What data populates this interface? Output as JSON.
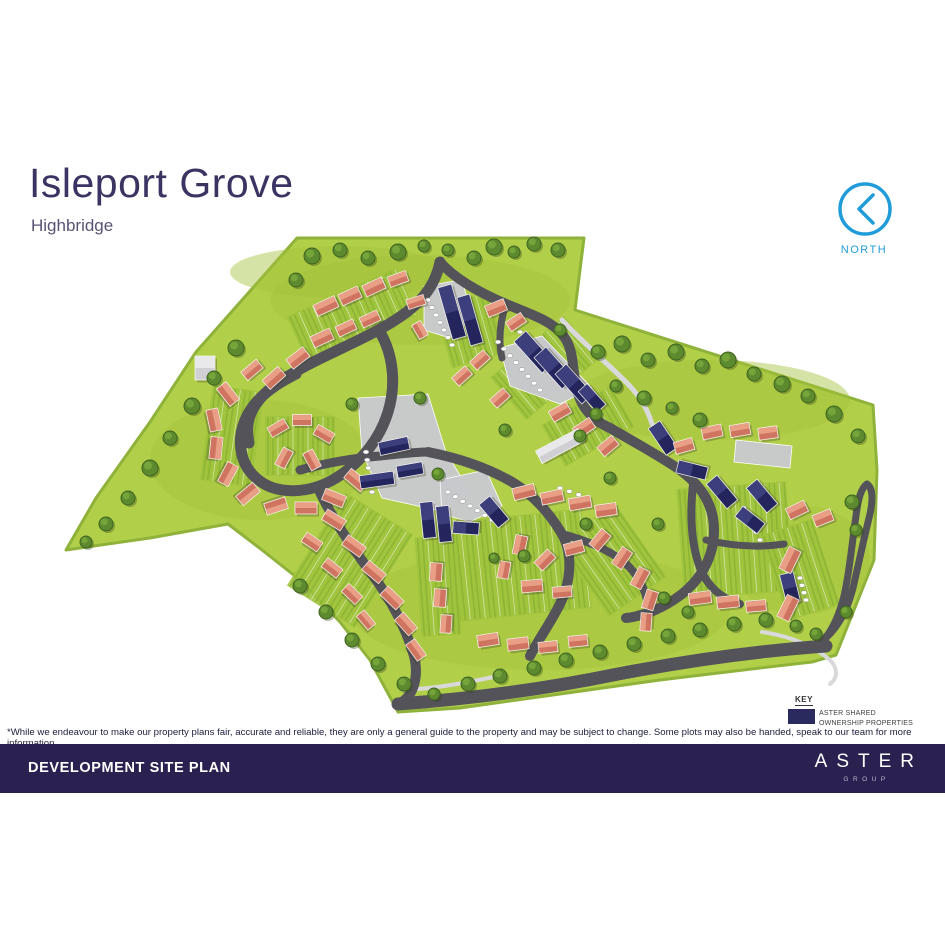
{
  "header": {
    "title": "Isleport Grove",
    "subtitle": "Highbridge"
  },
  "north": {
    "label": "NORTH",
    "color": "#1f9cd9"
  },
  "key": {
    "title": "KEY",
    "swatch_color": "#2b2a5e",
    "line1": "ASTER SHARED",
    "line2": "OWNERSHIP PROPERTIES"
  },
  "disclaimer": "*While we endeavour to make our property plans fair, accurate and reliable, they are only a general guide to the property and may be subject to change. Some plots may also be handed, speak to our team for more information.",
  "footer": {
    "title": "DEVELOPMENT SITE PLAN",
    "brand": "ASTER",
    "brand_sub": "GROUP",
    "bg": "#2a2150"
  },
  "map": {
    "colors": {
      "grass": "#b2cf4a",
      "grass_shade": "#a3c13b",
      "land_edge": "#8fb23a",
      "road": "#54535a",
      "path": "#d9d9dc",
      "parking": "#c9c9ce",
      "garden": "#9fc33d",
      "garden_stripe": "#84ab31",
      "sale_roof": "#cf7460",
      "sale_roof_light": "#e99f86",
      "shared_roof": "#23255c",
      "shared_roof_light": "#3d3f7d",
      "grey_roof": "#cfcfd4",
      "grey_roof_light": "#e9e9ec",
      "tree": "#5d8a2e",
      "tree_dark": "#3f6420",
      "tree_light": "#79a93c"
    },
    "land": [
      "M 297,238 L 584,238 L 575,310 L 873,405 L 877,470 L 874,560 L 836,655 L 812,662 L 760,668 L 660,680 L 560,694 L 460,708 L 398,712 L 370,660 L 340,622 L 300,580 L 262,550 L 228,524 L 150,538 L 66,550 L 96,498 L 150,422 L 196,352 Z"
    ],
    "shade": [
      [
        420,
        300,
        150,
        45
      ],
      [
        710,
        400,
        140,
        40
      ],
      [
        260,
        460,
        110,
        60
      ],
      [
        540,
        610,
        190,
        60
      ],
      [
        800,
        560,
        70,
        55
      ],
      [
        340,
        272,
        110,
        26
      ]
    ],
    "gardens": [
      [
        352,
        316,
        120,
        52,
        -24
      ],
      [
        470,
        330,
        56,
        64,
        -16
      ],
      [
        545,
        368,
        96,
        56,
        -40
      ],
      [
        232,
        436,
        52,
        96,
        8
      ],
      [
        300,
        446,
        70,
        60,
        0
      ],
      [
        350,
        560,
        80,
        110,
        32
      ],
      [
        512,
        566,
        150,
        100,
        -6
      ],
      [
        612,
        560,
        70,
        90,
        -35
      ],
      [
        735,
        540,
        110,
        110,
        -4
      ],
      [
        800,
        570,
        54,
        90,
        -18
      ],
      [
        588,
        426,
        80,
        48,
        -30
      ],
      [
        438,
        586,
        40,
        100,
        -4
      ]
    ],
    "parking": [
      "M 424,286 L 462,280 L 472,316 L 450,338 L 424,330 Z",
      "M 500,348 L 542,336 L 592,388 L 560,404 L 510,386 Z",
      "M 358,398 L 428,394 L 446,452 L 470,492 L 436,510 L 382,498 L 362,452 Z",
      "M 440,480 L 486,470 L 502,506 L 470,522 L 442,514 Z",
      "M 736,440 L 792,446 L 790,468 L 734,462 Z"
    ],
    "lightpaths": [
      [
        "M 562,320 C 584,344 606,362 626,382 C 640,396 648,410 652,424",
        5
      ],
      [
        "M 762,632 C 790,636 814,646 830,660 C 838,668 838,678 830,684",
        4
      ],
      [
        "M 404,690 C 440,688 470,682 498,676",
        4
      ]
    ],
    "roads": [
      [
        "M 440,262 C 434,292 414,310 382,328 C 350,346 312,360 282,380 C 256,397 243,417 249,443",
        11
      ],
      [
        "M 380,332 C 394,356 396,386 388,412 C 380,438 362,462 336,478 C 310,494 276,496 256,478 C 238,462 236,436 248,414 C 258,396 276,384 296,374",
        11
      ],
      [
        "M 300,470 C 330,462 355,458 380,456 C 400,454 415,452 428,452",
        9
      ],
      [
        "M 428,452 C 458,458 488,468 512,482 C 534,495 550,514 562,534 C 574,556 570,584 560,604 C 550,624 538,640 530,656",
        10
      ],
      [
        "M 440,262 C 454,278 478,292 506,304 C 530,314 550,320 562,334 C 574,348 572,366 576,386 C 580,406 592,420 610,428",
        10
      ],
      [
        "M 506,304 C 500,322 498,340 502,358",
        7
      ],
      [
        "M 610,428 C 634,442 660,456 680,470 C 702,486 714,506 714,530 C 714,556 702,578 682,594 C 664,608 644,616 626,618",
        10
      ],
      [
        "M 694,476 C 690,506 690,536 698,562 C 704,582 718,598 740,604",
        8
      ],
      [
        "M 706,540 C 732,546 758,548 784,544",
        7
      ],
      [
        "M 398,704 C 470,699 540,690 618,674 C 696,659 770,650 826,646",
        13
      ],
      [
        "M 812,650 C 828,640 838,620 844,596 C 850,570 852,542 856,516 C 858,499 861,488 867,484",
        7
      ],
      [
        "M 867,484 C 873,488 873,500 870,514 C 864,538 859,562 853,588 C 847,612 836,632 818,644",
        7
      ],
      [
        "M 318,488 C 330,514 348,542 369,570 C 390,598 406,628 414,656 C 419,676 414,694 402,702",
        10
      ],
      [
        "M 562,534 C 584,540 606,548 624,562 C 638,574 646,590 648,606",
        8
      ]
    ],
    "dot_rows": [
      [
        428,
        300,
        452,
        345,
        7
      ],
      [
        498,
        342,
        540,
        390,
        8
      ],
      [
        520,
        332,
        560,
        378,
        8
      ],
      [
        366,
        452,
        372,
        492,
        6
      ],
      [
        448,
        492,
        492,
        520,
        7
      ],
      [
        560,
        488,
        588,
        498,
        4
      ],
      [
        744,
        508,
        760,
        540,
        5
      ],
      [
        800,
        578,
        806,
        600,
        4
      ]
    ],
    "houses": [
      [
        326,
        306,
        23,
        12,
        -25,
        "s"
      ],
      [
        350,
        296,
        21,
        12,
        -25,
        "s"
      ],
      [
        374,
        287,
        21,
        12,
        -25,
        "s"
      ],
      [
        398,
        279,
        19,
        11,
        -20,
        "s"
      ],
      [
        322,
        338,
        21,
        12,
        -25,
        "s"
      ],
      [
        346,
        328,
        19,
        11,
        -25,
        "s"
      ],
      [
        370,
        319,
        19,
        11,
        -25,
        "s"
      ],
      [
        298,
        358,
        21,
        12,
        -38,
        "s"
      ],
      [
        274,
        378,
        21,
        12,
        -42,
        "s"
      ],
      [
        416,
        302,
        18,
        10,
        -18,
        "s"
      ],
      [
        420,
        330,
        16,
        10,
        60,
        "s"
      ],
      [
        452,
        312,
        14,
        54,
        -16,
        "n"
      ],
      [
        470,
        320,
        13,
        50,
        -16,
        "n"
      ],
      [
        496,
        308,
        20,
        12,
        -22,
        "s"
      ],
      [
        516,
        322,
        18,
        11,
        -34,
        "s"
      ],
      [
        534,
        352,
        16,
        42,
        -42,
        "n"
      ],
      [
        554,
        368,
        16,
        42,
        -42,
        "n"
      ],
      [
        574,
        384,
        15,
        40,
        -42,
        "n"
      ],
      [
        592,
        398,
        12,
        28,
        -42,
        "n"
      ],
      [
        480,
        360,
        18,
        11,
        -42,
        "s"
      ],
      [
        462,
        376,
        18,
        11,
        -42,
        "s"
      ],
      [
        500,
        398,
        18,
        11,
        -42,
        "s"
      ],
      [
        205,
        368,
        20,
        24,
        0,
        "g"
      ],
      [
        228,
        394,
        22,
        12,
        52,
        "s"
      ],
      [
        214,
        420,
        22,
        12,
        78,
        "s"
      ],
      [
        216,
        448,
        22,
        12,
        96,
        "s"
      ],
      [
        228,
        474,
        22,
        12,
        118,
        "s"
      ],
      [
        248,
        494,
        22,
        12,
        140,
        "s"
      ],
      [
        276,
        506,
        22,
        12,
        162,
        "s"
      ],
      [
        306,
        508,
        22,
        12,
        0,
        "s"
      ],
      [
        334,
        498,
        22,
        12,
        22,
        "s"
      ],
      [
        356,
        480,
        22,
        12,
        40,
        "s"
      ],
      [
        278,
        428,
        19,
        11,
        -30,
        "s"
      ],
      [
        302,
        420,
        19,
        11,
        0,
        "s"
      ],
      [
        324,
        434,
        19,
        11,
        30,
        "s"
      ],
      [
        312,
        460,
        19,
        11,
        62,
        "s"
      ],
      [
        284,
        458,
        19,
        11,
        -62,
        "s"
      ],
      [
        252,
        370,
        20,
        11,
        -40,
        "s"
      ],
      [
        394,
        446,
        30,
        13,
        -12,
        "n"
      ],
      [
        377,
        480,
        34,
        13,
        -8,
        "n"
      ],
      [
        410,
        470,
        26,
        12,
        -10,
        "n"
      ],
      [
        334,
        520,
        22,
        12,
        32,
        "s"
      ],
      [
        354,
        546,
        22,
        12,
        36,
        "s"
      ],
      [
        374,
        572,
        22,
        12,
        40,
        "s"
      ],
      [
        392,
        598,
        22,
        12,
        44,
        "s"
      ],
      [
        406,
        624,
        21,
        12,
        48,
        "s"
      ],
      [
        416,
        650,
        20,
        11,
        54,
        "s"
      ],
      [
        312,
        542,
        19,
        11,
        34,
        "s"
      ],
      [
        332,
        568,
        19,
        11,
        38,
        "s"
      ],
      [
        352,
        594,
        19,
        11,
        44,
        "s"
      ],
      [
        366,
        620,
        18,
        10,
        50,
        "s"
      ],
      [
        428,
        520,
        13,
        36,
        -6,
        "n"
      ],
      [
        444,
        524,
        13,
        36,
        -6,
        "n"
      ],
      [
        466,
        528,
        12,
        26,
        -86,
        "n"
      ],
      [
        494,
        512,
        14,
        30,
        -40,
        "n"
      ],
      [
        524,
        492,
        22,
        12,
        -14,
        "s"
      ],
      [
        552,
        497,
        22,
        12,
        -12,
        "s"
      ],
      [
        580,
        503,
        22,
        12,
        -10,
        "s"
      ],
      [
        606,
        510,
        21,
        12,
        -8,
        "s"
      ],
      [
        520,
        545,
        19,
        12,
        -78,
        "s"
      ],
      [
        545,
        560,
        19,
        12,
        -45,
        "s"
      ],
      [
        574,
        548,
        19,
        12,
        -15,
        "s"
      ],
      [
        532,
        586,
        21,
        12,
        -5,
        "s"
      ],
      [
        562,
        592,
        19,
        11,
        -5,
        "s"
      ],
      [
        504,
        570,
        17,
        11,
        -80,
        "s"
      ],
      [
        436,
        572,
        18,
        12,
        -86,
        "s"
      ],
      [
        440,
        598,
        18,
        12,
        -86,
        "s"
      ],
      [
        446,
        624,
        18,
        11,
        -86,
        "s"
      ],
      [
        488,
        640,
        21,
        12,
        -9,
        "s"
      ],
      [
        518,
        644,
        21,
        12,
        -7,
        "s"
      ],
      [
        548,
        647,
        19,
        11,
        -6,
        "s"
      ],
      [
        578,
        641,
        19,
        11,
        -6,
        "s"
      ],
      [
        600,
        540,
        20,
        12,
        -50,
        "s"
      ],
      [
        622,
        558,
        20,
        12,
        -56,
        "s"
      ],
      [
        640,
        578,
        20,
        12,
        -62,
        "s"
      ],
      [
        650,
        600,
        19,
        12,
        -72,
        "s"
      ],
      [
        646,
        622,
        18,
        11,
        -86,
        "s"
      ],
      [
        560,
        412,
        20,
        12,
        -30,
        "s"
      ],
      [
        584,
        428,
        20,
        12,
        -34,
        "s"
      ],
      [
        560,
        446,
        48,
        14,
        -28,
        "g"
      ],
      [
        608,
        446,
        19,
        12,
        -40,
        "s"
      ],
      [
        663,
        438,
        14,
        32,
        -34,
        "n"
      ],
      [
        684,
        446,
        19,
        12,
        -16,
        "s"
      ],
      [
        712,
        432,
        20,
        12,
        -12,
        "s"
      ],
      [
        740,
        430,
        20,
        12,
        -10,
        "s"
      ],
      [
        768,
        433,
        19,
        12,
        -8,
        "s"
      ],
      [
        692,
        470,
        13,
        30,
        -76,
        "n"
      ],
      [
        722,
        492,
        14,
        32,
        -40,
        "n"
      ],
      [
        762,
        496,
        14,
        32,
        -40,
        "n"
      ],
      [
        750,
        520,
        13,
        28,
        -52,
        "n"
      ],
      [
        790,
        588,
        14,
        30,
        -14,
        "n"
      ],
      [
        797,
        510,
        20,
        12,
        -26,
        "s"
      ],
      [
        823,
        518,
        19,
        12,
        -22,
        "s"
      ],
      [
        790,
        560,
        24,
        13,
        -64,
        "s"
      ],
      [
        788,
        608,
        24,
        13,
        -64,
        "s"
      ],
      [
        700,
        598,
        22,
        12,
        -8,
        "s"
      ],
      [
        728,
        602,
        22,
        12,
        -6,
        "s"
      ],
      [
        756,
        606,
        20,
        11,
        -5,
        "s"
      ]
    ],
    "trees": [
      [
        312,
        256,
        8
      ],
      [
        340,
        250,
        7
      ],
      [
        368,
        258,
        7
      ],
      [
        398,
        252,
        8
      ],
      [
        424,
        246,
        6
      ],
      [
        296,
        280,
        7
      ],
      [
        448,
        250,
        6
      ],
      [
        474,
        258,
        7
      ],
      [
        494,
        247,
        8
      ],
      [
        514,
        252,
        6
      ],
      [
        534,
        244,
        7
      ],
      [
        558,
        250,
        7
      ],
      [
        236,
        348,
        8
      ],
      [
        214,
        378,
        7
      ],
      [
        192,
        406,
        8
      ],
      [
        170,
        438,
        7
      ],
      [
        150,
        468,
        8
      ],
      [
        128,
        498,
        7
      ],
      [
        106,
        524,
        7
      ],
      [
        86,
        542,
        6
      ],
      [
        598,
        352,
        7
      ],
      [
        622,
        344,
        8
      ],
      [
        648,
        360,
        7
      ],
      [
        676,
        352,
        8
      ],
      [
        702,
        366,
        7
      ],
      [
        728,
        360,
        8
      ],
      [
        754,
        374,
        7
      ],
      [
        782,
        384,
        8
      ],
      [
        808,
        396,
        7
      ],
      [
        834,
        414,
        8
      ],
      [
        858,
        436,
        7
      ],
      [
        616,
        386,
        6
      ],
      [
        644,
        398,
        7
      ],
      [
        672,
        408,
        6
      ],
      [
        700,
        420,
        7
      ],
      [
        596,
        414,
        6
      ],
      [
        580,
        436,
        6
      ],
      [
        352,
        404,
        6
      ],
      [
        420,
        398,
        6
      ],
      [
        560,
        330,
        6
      ],
      [
        505,
        430,
        6
      ],
      [
        300,
        586,
        7
      ],
      [
        326,
        612,
        7
      ],
      [
        352,
        640,
        7
      ],
      [
        378,
        664,
        7
      ],
      [
        404,
        684,
        7
      ],
      [
        434,
        694,
        6
      ],
      [
        468,
        684,
        7
      ],
      [
        500,
        676,
        7
      ],
      [
        534,
        668,
        7
      ],
      [
        566,
        660,
        7
      ],
      [
        600,
        652,
        7
      ],
      [
        634,
        644,
        7
      ],
      [
        668,
        636,
        7
      ],
      [
        700,
        630,
        7
      ],
      [
        734,
        624,
        7
      ],
      [
        766,
        620,
        7
      ],
      [
        796,
        626,
        6
      ],
      [
        816,
        634,
        6
      ],
      [
        852,
        502,
        7
      ],
      [
        856,
        530,
        6
      ],
      [
        846,
        612,
        6
      ],
      [
        688,
        612,
        6
      ],
      [
        664,
        598,
        6
      ],
      [
        438,
        474,
        6
      ],
      [
        610,
        478,
        6
      ],
      [
        586,
        524,
        6
      ],
      [
        658,
        524,
        6
      ],
      [
        524,
        556,
        6
      ],
      [
        494,
        558,
        5
      ]
    ]
  }
}
